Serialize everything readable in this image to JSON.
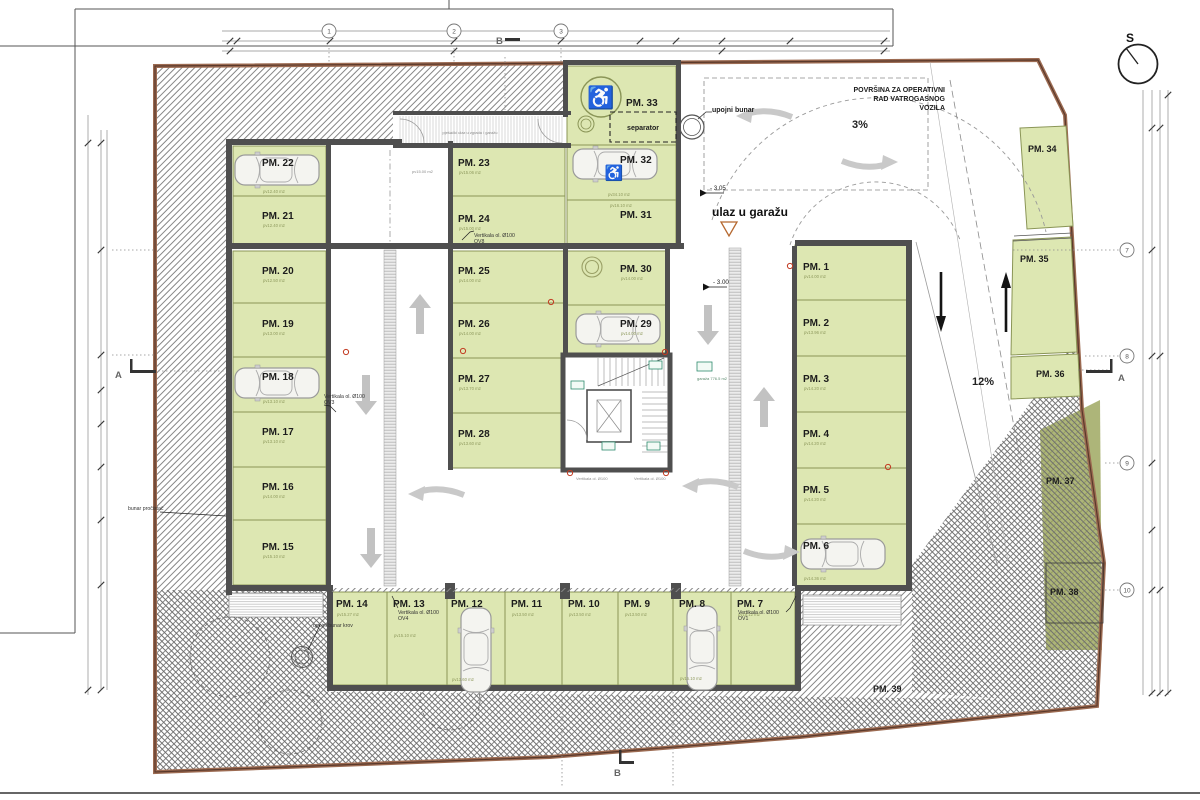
{
  "colors": {
    "parking_fill": "#dde7b2",
    "parking_stroke": "#8a9556",
    "wall": "#4f4f4f",
    "boundary": "#9c6b52",
    "terrain_hatch": "#858585",
    "arrow": "#c2c2c2",
    "red_marker": "#c23b22",
    "tag_green": "#2e8b6e",
    "olive_zone": "#99a258"
  },
  "icons": {
    "wheelchair": "♿"
  },
  "compass": {
    "label": "S"
  },
  "grid": {
    "top": [
      "1",
      "2",
      "3"
    ],
    "right": [
      "7",
      "8",
      "9",
      "10"
    ],
    "section_a": "A",
    "section_b": "B"
  },
  "annotations": {
    "entrance": "ulaz u garažu",
    "fire_area": [
      "POVRŠINA ZA OPERATIVNI",
      "RAD VATROGASNOG",
      "VOZILA"
    ],
    "slope_entry": "3%",
    "slope_ramp": "12%",
    "level_entry": "- 3.05",
    "level_garage": "- 3.00",
    "separator": "separator",
    "well_entry": "upojni bunar",
    "well_roof": "upojni bunar krov",
    "well_purifier": "bunar pročistač",
    "vertical_ov8_1": "Vertikala ol. Ø100",
    "vertical_ov8_2": "OV8",
    "vertical_ov3_1": "Vertikala ol. Ø100",
    "vertical_ov3_2": "OV3",
    "vertical_ov4_1": "Vertikala ol. Ø100",
    "vertical_ov4_2": "OV4",
    "vertical_ov1_1": "Vertikala ol. Ø100",
    "vertical_ov1_2": "OV1",
    "vertical_core_left": "Vertikala ol. Ø100",
    "vertical_core_right": "Vertikala ol. Ø100",
    "garage_tag": "garaža 776.5 m2",
    "corridor_note": "pješački ulaz u zgradu i garažu",
    "aisle_area": "pv15.00 m2"
  },
  "spots": [
    {
      "label": "PM. 1",
      "area": "pv14.00 m2"
    },
    {
      "label": "PM. 2",
      "area": "pv13.96 m2"
    },
    {
      "label": "PM. 3",
      "area": "pv14.20 m2"
    },
    {
      "label": "PM. 4",
      "area": "pv14.20 m2"
    },
    {
      "label": "PM. 5",
      "area": "pv14.20 m2"
    },
    {
      "label": "PM. 6",
      "area": "pv14.36 m2"
    },
    {
      "label": "PM. 7",
      "area": "pv15.12 m2"
    },
    {
      "label": "PM. 8",
      "area": "pv15.10 m2"
    },
    {
      "label": "PM. 9",
      "area": "pv13.50 m2"
    },
    {
      "label": "PM. 10",
      "area": "pv13.50 m2"
    },
    {
      "label": "PM. 11",
      "area": "pv13.50 m2"
    },
    {
      "label": "PM. 12",
      "area": "pv13.60 m2"
    },
    {
      "label": "PM. 13",
      "area": "pv15.10 m2"
    },
    {
      "label": "PM. 14",
      "area": "pv15.27 m2"
    },
    {
      "label": "PM. 15",
      "area": "pv15.10 m2"
    },
    {
      "label": "PM. 16",
      "area": "pv14.00 m2"
    },
    {
      "label": "PM. 17",
      "area": "pv13.10 m2"
    },
    {
      "label": "PM. 18",
      "area": "pv13.10 m2"
    },
    {
      "label": "PM. 19",
      "area": "pv13.00 m2"
    },
    {
      "label": "PM. 20",
      "area": "pv12.50 m2"
    },
    {
      "label": "PM. 21",
      "area": "pv12.40 m2"
    },
    {
      "label": "PM. 22",
      "area": "pv12.40 m2"
    },
    {
      "label": "PM. 23",
      "area": "pv15.06 m2"
    },
    {
      "label": "PM. 24",
      "area": "pv15.00 m2"
    },
    {
      "label": "PM. 25",
      "area": "pv14.00 m2"
    },
    {
      "label": "PM. 26",
      "area": "pv14.00 m2"
    },
    {
      "label": "PM. 27",
      "area": "pv13.70 m2"
    },
    {
      "label": "PM. 28",
      "area": "pv13.60 m2"
    },
    {
      "label": "PM. 29",
      "area": "pv14.00 m2"
    },
    {
      "label": "PM. 30",
      "area": "pv14.00 m2"
    },
    {
      "label": "PM. 31",
      "area": "pv16.10 m2"
    },
    {
      "label": "PM. 32",
      "area": "pv34.10 m2"
    },
    {
      "label": "PM. 33",
      "area": ""
    },
    {
      "label": "PM. 34",
      "area": ""
    },
    {
      "label": "PM. 35",
      "area": ""
    },
    {
      "label": "PM. 36",
      "area": ""
    },
    {
      "label": "PM. 37",
      "area": ""
    },
    {
      "label": "PM. 38",
      "area": ""
    },
    {
      "label": "PM. 39",
      "area": ""
    }
  ]
}
